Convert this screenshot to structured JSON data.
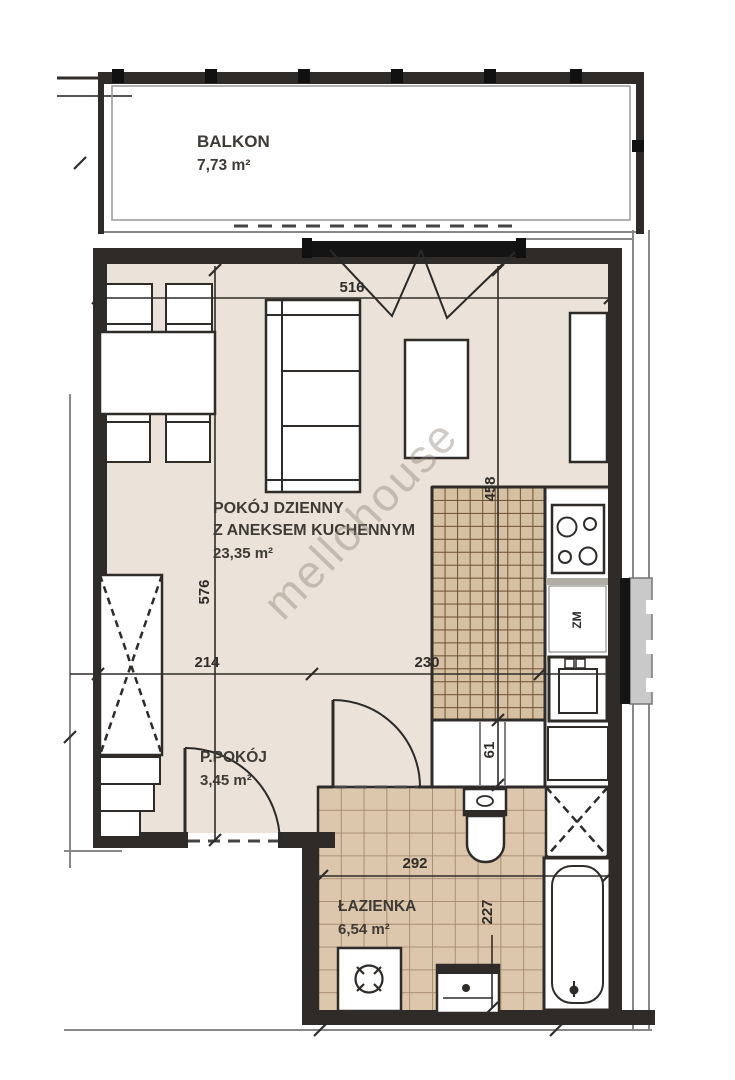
{
  "plan_title": "apartment-floor-plan",
  "watermark": {
    "text": "mellohouse"
  },
  "rooms": {
    "balcony": {
      "label": "BALKON",
      "area": "7,73 m²"
    },
    "living_room": {
      "label_line1": "POKÓJ DZIENNY",
      "label_line2": "Z ANEKSEM KUCHENNYM",
      "area": "23,35 m²"
    },
    "hallway": {
      "label": "P.POKÓJ",
      "area": "3,45 m²"
    },
    "bathroom": {
      "label": "ŁAZIENKA",
      "area": "6,54 m²"
    }
  },
  "dimensions": {
    "balcony_wall": "516",
    "living_depth": "576",
    "kitchen_side": "458",
    "seg_214": "214",
    "seg_230": "230",
    "seg_61": "61",
    "bathroom_width": "292",
    "bathroom_depth": "227"
  },
  "appliances": {
    "dishwasher": "ZM"
  },
  "colors": {
    "floor": "#ebe3d9",
    "kitchen_tile": "#d5c1a2",
    "kitchen_grout": "#6d4f2f",
    "bath_tile": "#dcc7ad",
    "bath_grout": "#a6886a",
    "wall": "#2e2b28",
    "watermark": "#8f857a"
  }
}
